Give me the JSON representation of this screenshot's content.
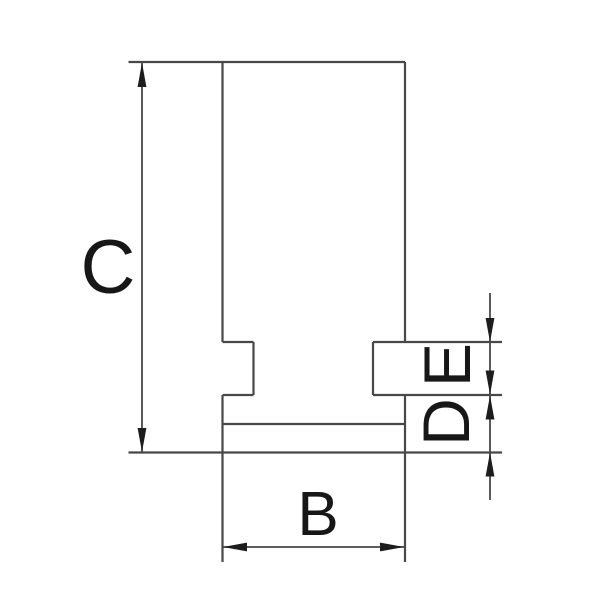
{
  "drawing": {
    "description": "Technical side-profile drawing of a lathe chuck jaw with dimension callouts",
    "background_color": "#ffffff",
    "line_color": "#48484b",
    "arrow_color": "#1d1d1f",
    "text_color": "#171717",
    "labels": {
      "c": "C",
      "b": "B",
      "d": "D",
      "e": "E"
    }
  }
}
